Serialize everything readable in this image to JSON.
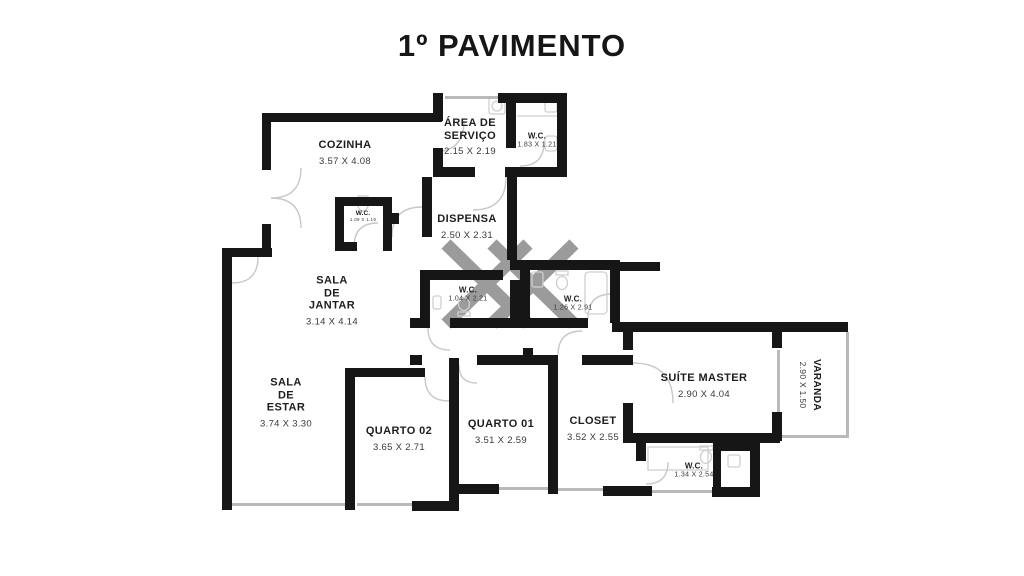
{
  "title": "1º PAVIMENTO",
  "style": {
    "wall_color": "#161616",
    "window_color": "#b9b9b9",
    "door_arc_color": "#c8c8c8",
    "shaft_cross_color": "#9b9b9b"
  },
  "rooms": [
    {
      "id": "cozinha",
      "name": "COZINHA",
      "dims": "3.57 X 4.08"
    },
    {
      "id": "area-servico",
      "name": "ÁREA DE\nSERVIÇO",
      "dims": "2.15 X 2.19"
    },
    {
      "id": "wc-servico",
      "name": "W.C.",
      "dims": "1.83 X 1.21"
    },
    {
      "id": "wc-cozinha",
      "name": "W.C.",
      "dims": "1.09 X 1.19"
    },
    {
      "id": "dispensa",
      "name": "DISPENSA",
      "dims": "2.50 X 2.31"
    },
    {
      "id": "sala-jantar",
      "name": "SALA\nDE\nJANTAR",
      "dims": "3.14 X 4.14"
    },
    {
      "id": "sala-estar",
      "name": "SALA\nDE\nESTAR",
      "dims": "3.74 X 3.30"
    },
    {
      "id": "wc-social",
      "name": "W.C.",
      "dims": "1.04 X 2.21"
    },
    {
      "id": "wc-suite2",
      "name": "W.C.",
      "dims": "1.26 X 2.91"
    },
    {
      "id": "quarto-02",
      "name": "QUARTO 02",
      "dims": "3.65 X 2.71"
    },
    {
      "id": "quarto-01",
      "name": "QUARTO 01",
      "dims": "3.51 X 2.59"
    },
    {
      "id": "closet",
      "name": "CLOSET",
      "dims": "3.52 X 2.55"
    },
    {
      "id": "suite-master",
      "name": "SUÍTE MASTER",
      "dims": "2.90 X 4.04"
    },
    {
      "id": "varanda",
      "name": "VARANDA",
      "dims": "2.90 X 1.50"
    },
    {
      "id": "wc-master",
      "name": "W.C.",
      "dims": "1.34 X 2.54"
    }
  ]
}
